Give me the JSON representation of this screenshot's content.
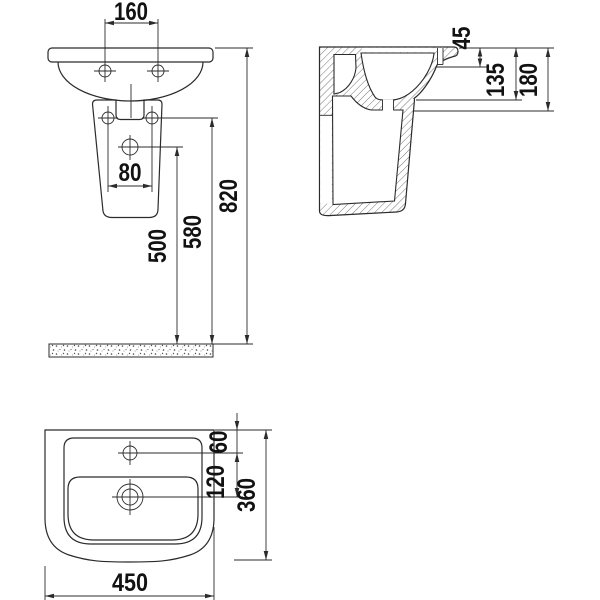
{
  "drawing": {
    "kind": "washbasin technical installation drawing",
    "background_color": "#ffffff",
    "line_color": "#2b2b2b"
  },
  "views": {
    "front_elevation": {
      "dimensions": {
        "tap_holes_spacing": "160",
        "pedestal_holes_spacing": "80",
        "height_to_drain": "500",
        "height_to_fixings": "580",
        "height_to_rim": "820"
      }
    },
    "side_section": {
      "dimensions": {
        "rim_to_deck": "45",
        "rim_to_bowl_bottom": "135",
        "basin_total_depth": "180"
      }
    },
    "top_plan": {
      "dimensions": {
        "edge_to_tap_hole": "60",
        "tap_hole_to_drain": "120",
        "basin_depth": "360",
        "basin_width": "450"
      }
    }
  }
}
